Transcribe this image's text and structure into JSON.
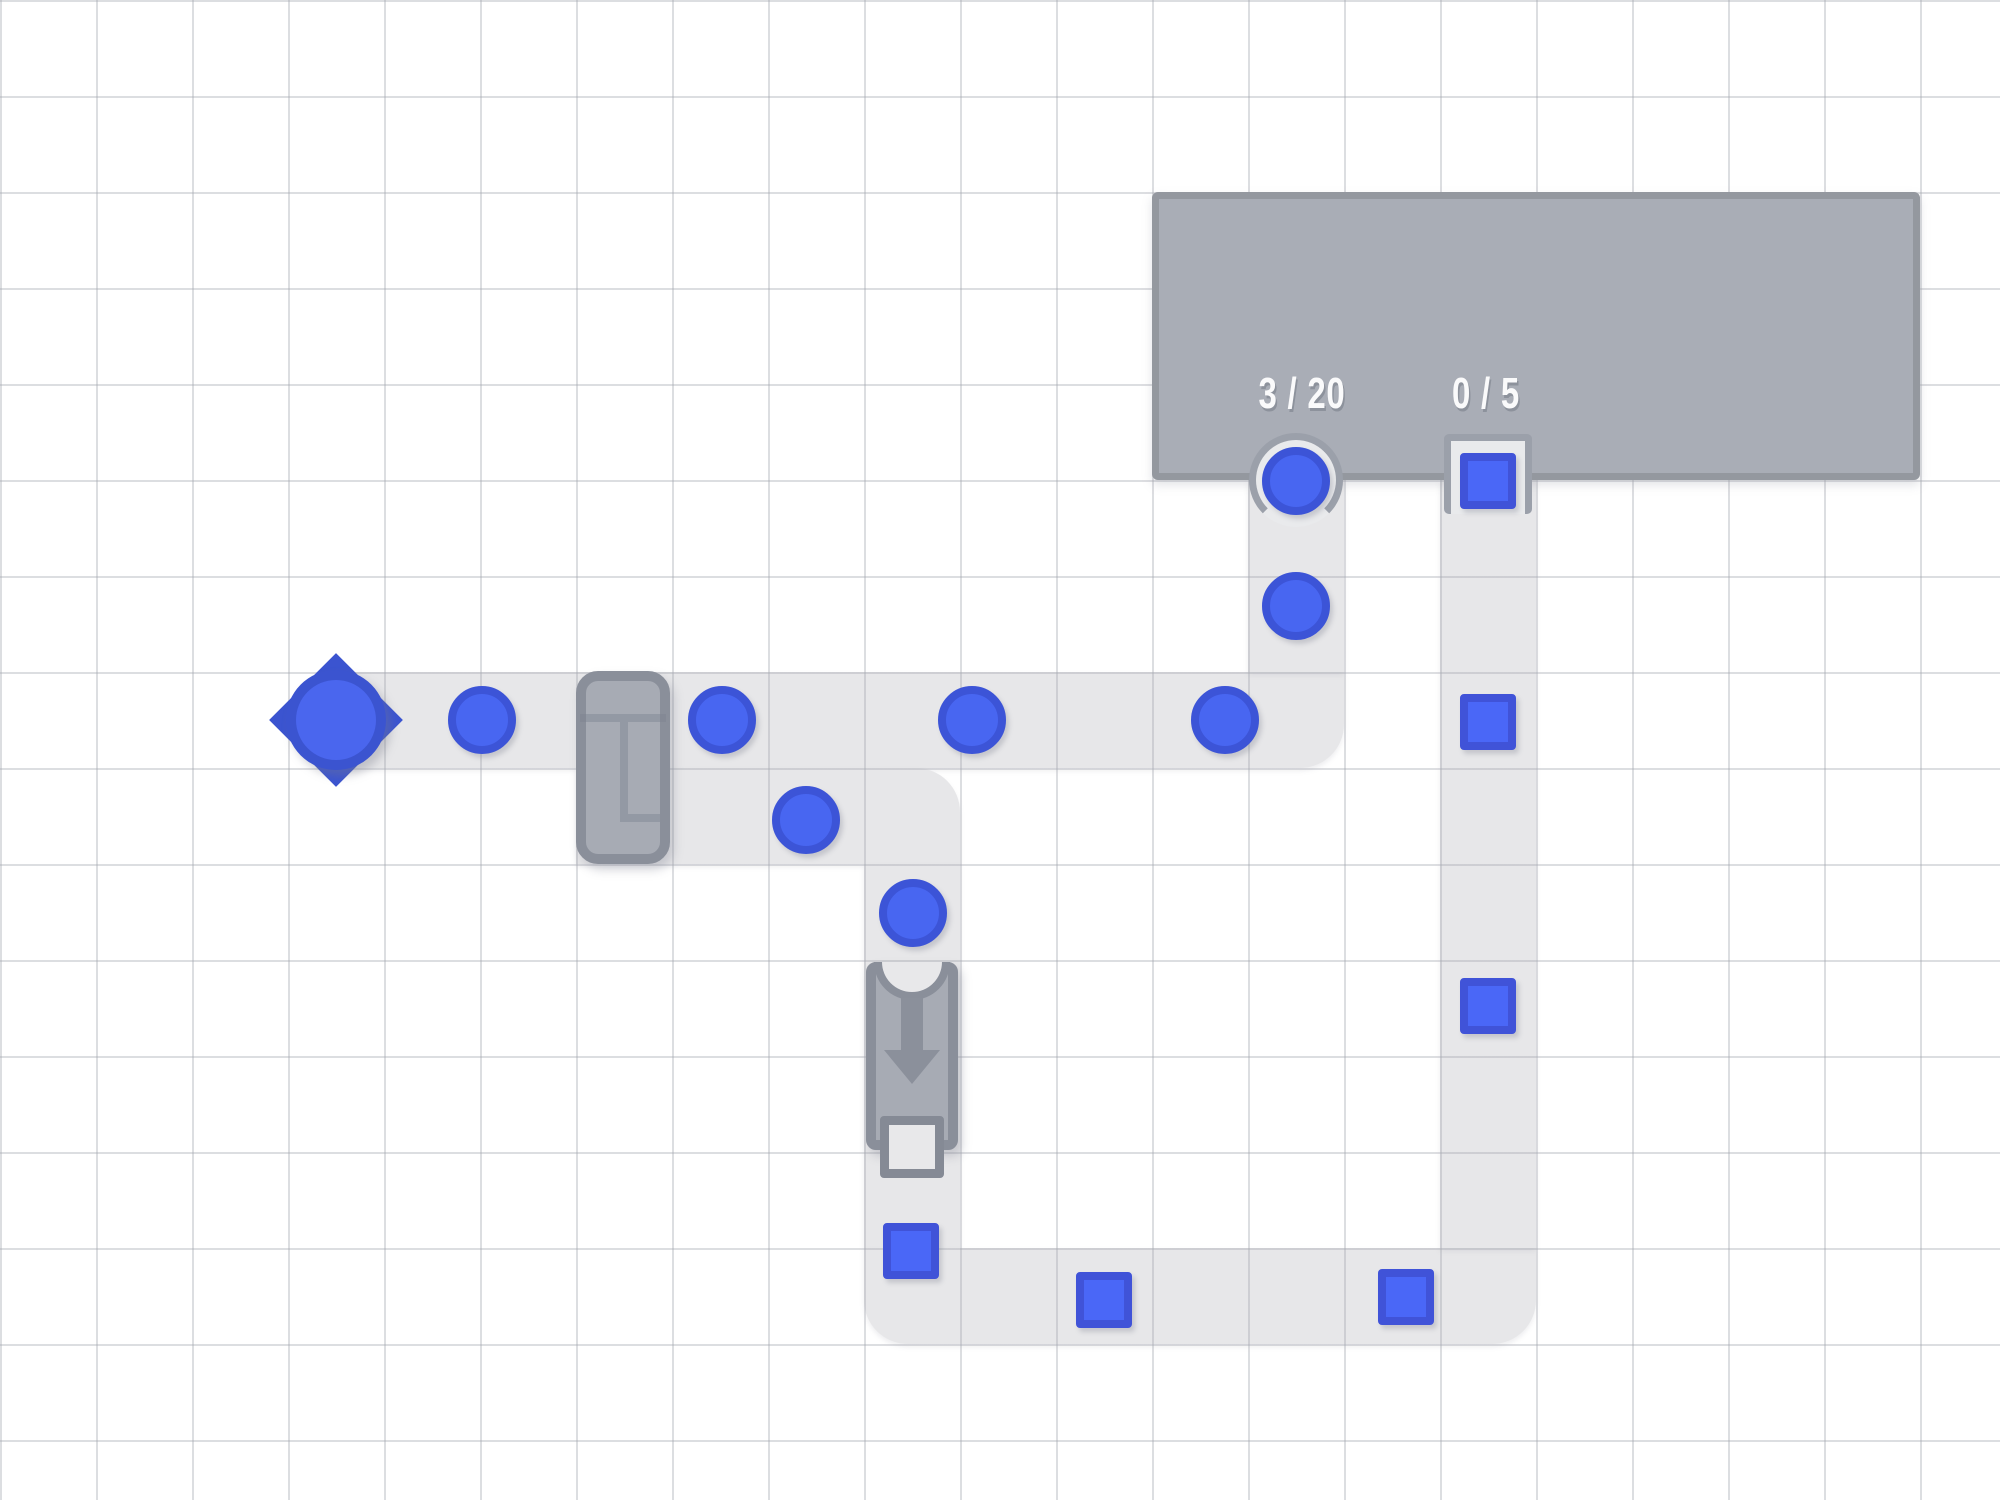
{
  "scene": {
    "width": 2000,
    "height": 1500,
    "cell_size": 96
  },
  "palette": {
    "background": "#ffffff",
    "grid_line": "#dfe1e5",
    "belt": "#e7e7e9",
    "structure_fill": "#a7abb4",
    "machine_border": "#8a8f9a",
    "depot_fill": "#a9adb6",
    "depot_border": "#94989f",
    "pocket_fill": "#e9eaec",
    "pocket_rim": "#9ba0aa",
    "item_fill": "#4866f1",
    "item_rim": "#3c54d7",
    "label_text": "#fafafb"
  },
  "depot": {
    "circle_counter": "3 / 20",
    "square_counter": "0 / 5"
  },
  "belts": [
    {
      "name": "belt-row7",
      "x": 336,
      "y": 672,
      "w": 1008,
      "h": 96,
      "radius": "0 0 44px 0"
    },
    {
      "name": "belt-col13",
      "x": 1248,
      "y": 480,
      "w": 96,
      "h": 192,
      "radius": "0"
    },
    {
      "name": "belt-row8",
      "x": 576,
      "y": 768,
      "w": 384,
      "h": 96,
      "radius": "0 44px 0 0"
    },
    {
      "name": "belt-col9",
      "x": 864,
      "y": 864,
      "w": 96,
      "h": 384,
      "radius": "0"
    },
    {
      "name": "belt-row13",
      "x": 864,
      "y": 1248,
      "w": 672,
      "h": 96,
      "radius": "0 0 44px 44px"
    },
    {
      "name": "belt-col15",
      "x": 1440,
      "y": 480,
      "w": 96,
      "h": 768,
      "radius": "0"
    }
  ],
  "items": {
    "circles": [
      {
        "x": 482,
        "y": 720
      },
      {
        "x": 722,
        "y": 720
      },
      {
        "x": 972,
        "y": 720
      },
      {
        "x": 1225,
        "y": 720
      },
      {
        "x": 1296,
        "y": 606
      },
      {
        "x": 1296,
        "y": 481
      },
      {
        "x": 806,
        "y": 820
      },
      {
        "x": 913,
        "y": 913
      }
    ],
    "squares": [
      {
        "x": 1488,
        "y": 481
      },
      {
        "x": 1488,
        "y": 722
      },
      {
        "x": 1488,
        "y": 1006
      },
      {
        "x": 911,
        "y": 1251
      },
      {
        "x": 1104,
        "y": 1300
      },
      {
        "x": 1406,
        "y": 1297
      }
    ]
  }
}
